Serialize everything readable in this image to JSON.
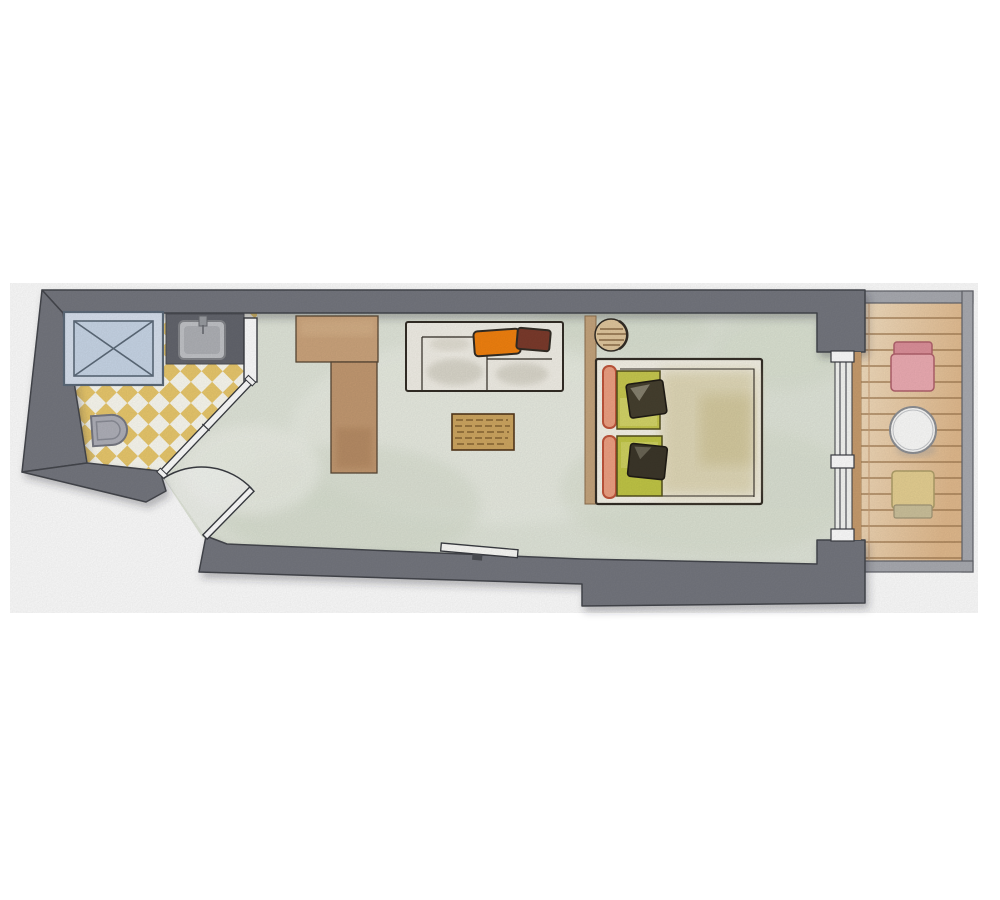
{
  "plan": {
    "kind": "floor-plan",
    "style": "watercolor",
    "rooms": [
      {
        "name": "bathroom",
        "floor": "yellow-white-checkered-tile",
        "fixtures": [
          "shower",
          "washbasin-counter",
          "toilet",
          "diagonal-sliding-door"
        ]
      },
      {
        "name": "living-sleeping-room",
        "floor": "sage-green-wash",
        "furniture": [
          "wardrobe-t-shape",
          "sofa",
          "orange-pillow",
          "maroon-pillow",
          "coffee-table",
          "tv-board",
          "headboard-partition",
          "round-stool",
          "double-bed",
          "green-pillows",
          "dark-cushions",
          "salmon-bolsters",
          "entry-door-with-swing"
        ]
      },
      {
        "name": "balcony",
        "floor": "wood-plank-deck",
        "furniture": [
          "pink-chair",
          "round-table",
          "beige-chair"
        ],
        "features": [
          "railing",
          "sliding-glass-door"
        ]
      }
    ]
  },
  "colors": {
    "page_bg": "#ffffff",
    "wall": "#75777f",
    "wall_outline": "#45474e",
    "floor_main": "#e2e7db",
    "tile_yellow": "#eac96d",
    "tile_white": "#fcfbf2",
    "shower_blue": "#c9d7e8",
    "shower_blue_light": "#d8e2ef",
    "shower_frame": "#5d6b7a",
    "counter_gray": "#64666e",
    "basin_gray": "#c2c4c8",
    "fixture_gray": "#b0b1ba",
    "wood_light": "#cda57d",
    "wood_mid": "#c49a72",
    "divider_wood": "#c6a57d",
    "stool_wood": "#e2c89e",
    "coffee_table": "#cfa761",
    "deck_light": "#f4e0c2",
    "deck_dark": "#e3bb8e",
    "deck_line": "#a07a50",
    "rail_gray": "#aaacb2",
    "wood_frame": "#c99d6e",
    "glazing_white": "#f7f8f5",
    "sofa_ivory": "#f3f0e8",
    "pillow_orange": "#f3820f",
    "pillow_maroon": "#7c3b2c",
    "bed_ivory": "#f7f4e9",
    "bed_wash": "#d9cfa4",
    "pillow_green": "#c8c94f",
    "pillow_green2": "#c2c746",
    "cushion_dark": "#46402f",
    "cushion_dark2": "#3c372a",
    "bolster_salmon": "#efa183",
    "chair_pink": "#eeadb4",
    "chair_pink_dark": "#de919b",
    "chair_beige": "#e7d193",
    "table_white": "#fdfdfc",
    "door_white": "#ffffff",
    "sketch": "#332d26"
  }
}
